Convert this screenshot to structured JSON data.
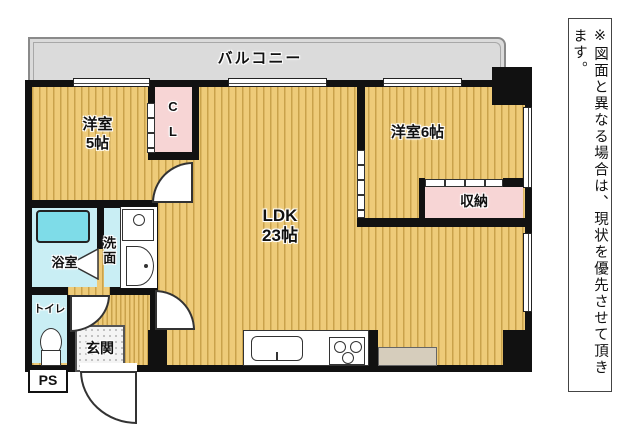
{
  "floorplan": {
    "balcony": {
      "label": "バルコニー"
    },
    "rooms": {
      "bedroom5": {
        "label_line1": "洋室",
        "label_line2": "5帖"
      },
      "closet": {
        "label_line1": "C",
        "label_line2": "L"
      },
      "bedroom6": {
        "label": "洋室6帖"
      },
      "storage": {
        "label": "収納"
      },
      "ldk": {
        "label_line1": "LDK",
        "label_line2": "23帖"
      },
      "bathroom": {
        "label": "浴室"
      },
      "washroom": {
        "label": "洗面"
      },
      "toilet": {
        "label": "トイレ"
      },
      "entrance": {
        "label": "玄関"
      },
      "pipe_space": {
        "label": "PS"
      }
    },
    "colors": {
      "floor_base": "#eecb79",
      "floor_stripe": "#c9a24b",
      "closet_pink": "#f7d5d5",
      "wet_area_cyan": "#c9eef4",
      "bathtub": "#7edce8",
      "balcony_gray": "#dbdbdb",
      "wall_black": "#111111",
      "counter_beige": "#d6cdbc"
    }
  },
  "disclaimer": {
    "text": "※図面と異なる場合は、現状を優先させて頂きます。"
  }
}
